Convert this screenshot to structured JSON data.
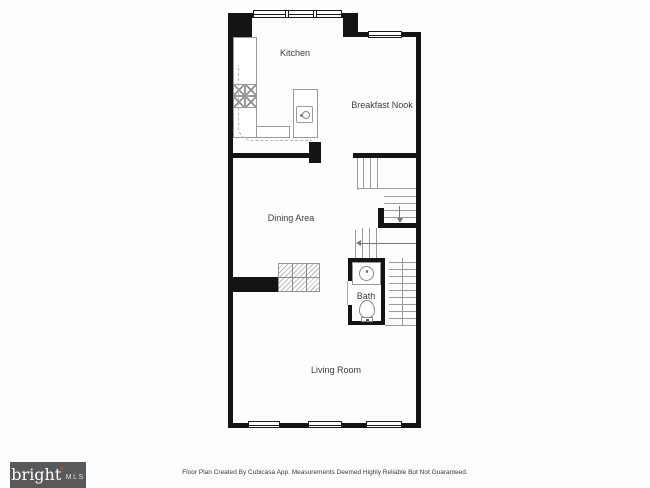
{
  "rooms": {
    "kitchen": "Kitchen",
    "breakfast_nook": "Breakfast Nook",
    "dining_area": "Dining Area",
    "bath": "Bath",
    "living_room": "Living Room"
  },
  "logo": {
    "brand": "bright",
    "star": "*",
    "suffix": "MLS"
  },
  "footer": {
    "disclaimer": "Floor Plan Created By Cubicasa App. Measurements Deemed Highly Reliable But Not Guaranteed."
  },
  "colors": {
    "wall": "#141414",
    "fixture_line": "#9a9a9a",
    "label_text": "#3d3d3d",
    "logo_background": "#58595b",
    "logo_star": "#e05206",
    "background": "#fdfdfd"
  }
}
